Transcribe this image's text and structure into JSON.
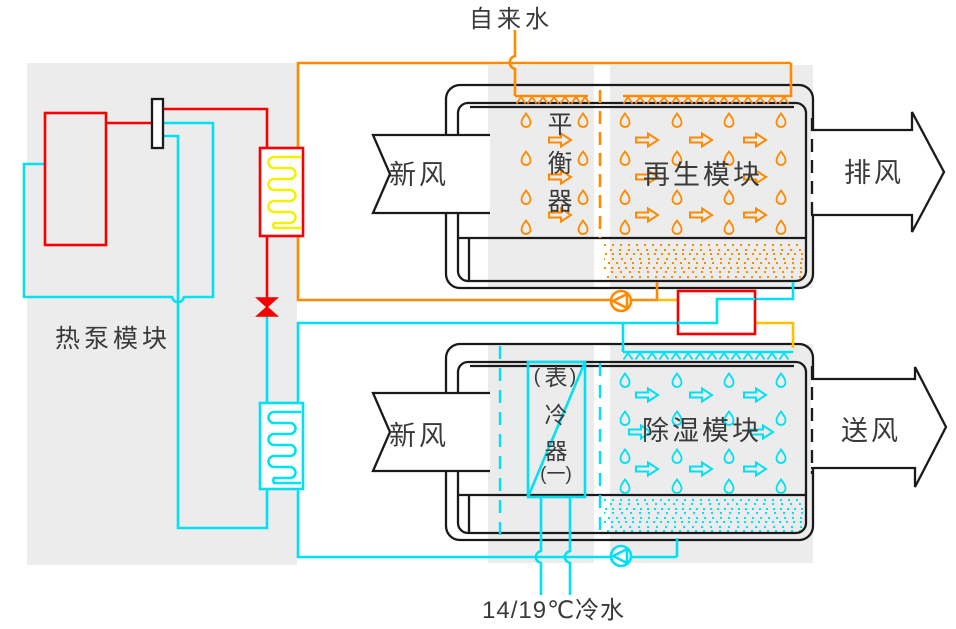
{
  "labels": {
    "tap_water": "自来水",
    "fresh_air_top": "新风",
    "fresh_air_bottom": "新风",
    "exhaust_air": "排风",
    "supply_air": "送风",
    "heat_pump_module": "热泵模块",
    "regeneration_module": "再生模块",
    "dehumidification_module": "除湿模块",
    "balancer_chars": [
      "平",
      "衡",
      "器"
    ],
    "cooler_chars": [
      "表",
      "冷",
      "器"
    ],
    "cooler_paren_left": "(",
    "cooler_paren_right": ")",
    "cooler_index": "(一)",
    "chilled_water": "14/19℃冷水"
  },
  "icons": {
    "pump": "circle-with-triangle",
    "expansion_valve": "bowtie-valve",
    "spray_header": "zigzag-nozzles",
    "droplet": "hollow-teardrop",
    "air_flow_arrow": "hollow-right-arrow"
  },
  "colors": {
    "regeneration_circuit": "#FF8A00",
    "hot_transfer": "#FFC000",
    "dehumidification_circuit": "#00E1F4",
    "refrigerant_hot": "#F60000",
    "condenser_coil": "#F2F200",
    "panel_gray": "#ECECEC",
    "casing_black": "#1A1A1A",
    "text": "#3A3A3A"
  }
}
